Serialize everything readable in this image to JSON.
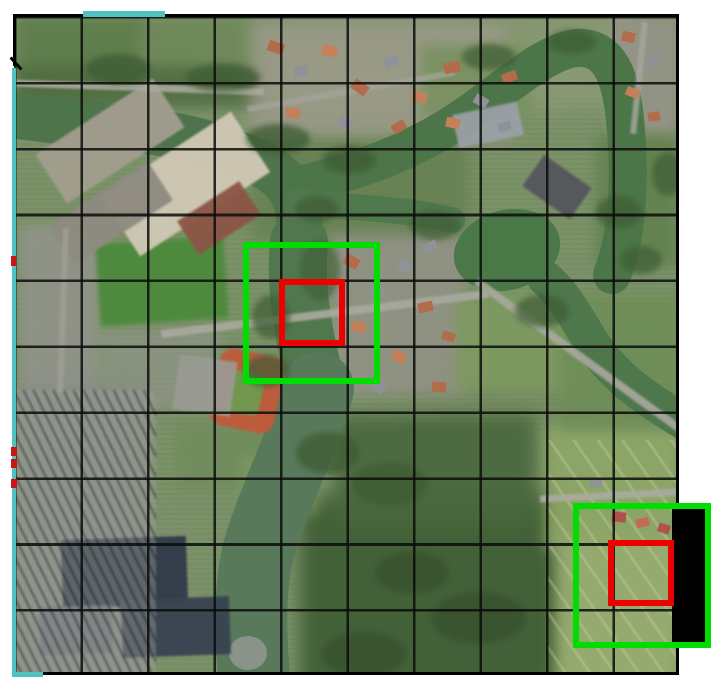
{
  "canvas": {
    "width": 716,
    "height": 687,
    "background": "#ffffff"
  },
  "aerial": {
    "left": 14,
    "top": 16,
    "width": 665,
    "height": 659
  },
  "grid": {
    "columns": 10,
    "rows": 10,
    "cell_width": 66.5,
    "cell_height": 65.9,
    "line_color": "rgba(10,12,10,0.85)",
    "line_width": 2.6
  },
  "annotations": {
    "context_box_color": "#00dd00",
    "target_box_color": "#ee0000",
    "box_border_width": 6,
    "context_boxes": [
      {
        "x": 243,
        "y": 242,
        "w": 137,
        "h": 142
      },
      {
        "x": 573,
        "y": 503,
        "w": 138,
        "h": 145
      }
    ],
    "target_boxes": [
      {
        "x": 279,
        "y": 279,
        "w": 66,
        "h": 67
      },
      {
        "x": 608,
        "y": 540,
        "w": 66,
        "h": 66
      }
    ],
    "out_of_bounds_mask": {
      "x": 672,
      "y": 507,
      "w": 37,
      "h": 135,
      "color": "#000000"
    },
    "boundary": {
      "color": "#000000",
      "segments": [
        {
          "x": 13,
          "y": 14,
          "w": 666,
          "h": 3
        },
        {
          "x": 676,
          "y": 14,
          "w": 3,
          "h": 661
        },
        {
          "x": 13,
          "y": 672,
          "w": 666,
          "h": 3
        },
        {
          "x": 13,
          "y": 14,
          "w": 3,
          "h": 52
        },
        {
          "x": 8,
          "y": 62,
          "w": 16,
          "h": 3,
          "rot": 48
        }
      ]
    },
    "footprint": {
      "color": "#4fc3c3",
      "segments": [
        {
          "x": 83,
          "y": 11,
          "w": 82,
          "h": 6
        },
        {
          "x": 12,
          "y": 68,
          "w": 4,
          "h": 609
        },
        {
          "x": 12,
          "y": 672,
          "w": 31,
          "h": 5
        }
      ]
    },
    "edge_ticks": {
      "color": "#cc1414",
      "segments": [
        {
          "x": 11,
          "y": 256,
          "w": 5,
          "h": 10
        },
        {
          "x": 11,
          "y": 447,
          "w": 6,
          "h": 9
        },
        {
          "x": 11,
          "y": 459,
          "w": 6,
          "h": 9
        },
        {
          "x": 11,
          "y": 479,
          "w": 6,
          "h": 9
        }
      ]
    }
  },
  "scene": {
    "water_color": "#4e744b",
    "rivers": [
      {
        "d": "M 5 114 C 90 128 190 124 268 168 C 298 186 302 214 299 246",
        "w": 46,
        "c": "#4e744b"
      },
      {
        "d": "M 299 242 C 294 292 305 342 318 392",
        "w": 58,
        "c": "#51774f"
      },
      {
        "d": "M 318 388 C 300 450 272 502 258 552 C 248 596 251 642 255 690",
        "w": 72,
        "c": "#587a5a"
      },
      {
        "d": "M 294 186 C 360 172 424 148 482 104 C 520 76 548 52 576 48 C 612 46 622 80 626 130 C 630 180 628 235 612 275",
        "w": 38,
        "c": "#4c7649"
      },
      {
        "d": "M 296 202 C 350 208 402 208 452 220",
        "w": 26,
        "c": "#50784d"
      },
      {
        "d": "M 545 278 C 572 302 582 332 602 357 C 626 386 652 402 684 422",
        "w": 36,
        "c": "#4e774c"
      }
    ],
    "ponds": [
      {
        "cx": 507,
        "cy": 250,
        "rx": 54,
        "ry": 40,
        "c": "#4a7847",
        "rot": -15
      },
      {
        "cx": 248,
        "cy": 653,
        "rx": 19,
        "ry": 17,
        "c": "#8a938a",
        "rot": 0
      }
    ],
    "features": [
      {
        "x": 16,
        "y": 16,
        "w": 130,
        "h": 80,
        "c": "#5d7c4b",
        "bl": 7,
        "o": 0.9,
        "layer": 0
      },
      {
        "x": 140,
        "y": 20,
        "w": 120,
        "h": 70,
        "c": "#6c8756",
        "bl": 7,
        "o": 0.8,
        "layer": 0
      },
      {
        "x": 16,
        "y": 66,
        "w": 250,
        "h": 42,
        "c": "#4f6c41",
        "bl": 6,
        "o": 0.85,
        "layer": 0
      },
      {
        "x": 250,
        "y": 20,
        "w": 260,
        "h": 120,
        "c": "#9b9a89",
        "bl": 8,
        "o": 0.85,
        "layer": 0
      },
      {
        "x": 508,
        "y": 16,
        "w": 120,
        "h": 90,
        "c": "#8a9a74",
        "bl": 8,
        "o": 0.8,
        "layer": 0
      },
      {
        "x": 610,
        "y": 16,
        "w": 68,
        "h": 120,
        "c": "#97948a",
        "bl": 6,
        "o": 0.85,
        "layer": 0
      },
      {
        "x": 250,
        "y": 140,
        "w": 220,
        "h": 100,
        "c": "#647f50",
        "bl": 8,
        "o": 0.8,
        "layer": 0
      },
      {
        "x": 330,
        "y": 235,
        "w": 135,
        "h": 160,
        "c": "#95928a",
        "bl": 7,
        "o": 0.8,
        "layer": 0
      },
      {
        "x": 20,
        "y": 225,
        "w": 80,
        "h": 170,
        "c": "#93948c",
        "bl": 6,
        "o": 0.85,
        "layer": 0
      },
      {
        "x": 100,
        "y": 330,
        "w": 120,
        "h": 80,
        "c": "#8f9488",
        "bl": 6,
        "o": 0.7,
        "layer": 0
      },
      {
        "x": 16,
        "y": 385,
        "w": 130,
        "h": 300,
        "c": "#878b86",
        "bl": 8,
        "o": 0.9,
        "layer": 0
      },
      {
        "x": 300,
        "y": 495,
        "w": 270,
        "h": 195,
        "c": "#415f36",
        "bl": 9,
        "o": 0.95,
        "layer": 0
      },
      {
        "x": 335,
        "y": 415,
        "w": 200,
        "h": 110,
        "c": "#4a683d",
        "bl": 8,
        "o": 0.9,
        "layer": 0
      },
      {
        "x": 545,
        "y": 425,
        "w": 135,
        "h": 125,
        "c": "#8ea868",
        "bl": 7,
        "o": 0.9,
        "layer": 0
      },
      {
        "x": 555,
        "y": 540,
        "w": 125,
        "h": 148,
        "c": "#97ac70",
        "bl": 7,
        "o": 0.95,
        "layer": 0
      },
      {
        "x": 455,
        "y": 295,
        "w": 130,
        "h": 95,
        "c": "#7e9b60",
        "bl": 7,
        "o": 0.85,
        "layer": 0
      },
      {
        "x": 560,
        "y": 295,
        "w": 120,
        "h": 135,
        "c": "#6e8d56",
        "bl": 7,
        "o": 0.85,
        "layer": 0
      },
      {
        "x": 596,
        "y": 135,
        "w": 84,
        "h": 130,
        "c": "#5f804c",
        "bl": 7,
        "o": 0.8,
        "layer": 0
      },
      {
        "x": 420,
        "y": 45,
        "w": 110,
        "h": 75,
        "c": "#74905a",
        "bl": 7,
        "o": 0.8,
        "layer": 0
      },
      {
        "x": 175,
        "y": 420,
        "w": 130,
        "h": 70,
        "c": "#6f8c59",
        "bl": 6,
        "o": 0.7,
        "layer": 0
      },
      {
        "x": 240,
        "y": 455,
        "w": 80,
        "h": 60,
        "c": "#7f9a64",
        "bl": 6,
        "o": 0.6,
        "layer": 0
      },
      {
        "x": 548,
        "y": 440,
        "w": 132,
        "h": 245,
        "g": "repeating-linear-gradient(55deg, rgba(205,210,160,0.4) 0 3px, rgba(0,0,0,0) 3px 20px)",
        "bl": 0,
        "o": 0.8,
        "layer": 1
      },
      {
        "x": 98,
        "y": 240,
        "w": 128,
        "h": 82,
        "c": "#4c8a3c",
        "r": -4,
        "bl": 2,
        "o": 0.95,
        "layer": 1
      },
      {
        "x": 214,
        "y": 352,
        "w": 66,
        "h": 78,
        "c": "#c05a3a",
        "r": 12,
        "br": 14,
        "bl": 1,
        "o": 0.95,
        "layer": 1
      },
      {
        "x": 228,
        "y": 372,
        "w": 34,
        "h": 42,
        "c": "#6e9a50",
        "r": 12,
        "br": 8,
        "bl": 1,
        "o": 0.95,
        "layer": 1
      },
      {
        "x": 176,
        "y": 358,
        "w": 58,
        "h": 55,
        "c": "#9a9c94",
        "r": 8,
        "bl": 1,
        "o": 0.9,
        "layer": 1
      },
      {
        "x": 40,
        "y": 112,
        "w": 140,
        "h": 58,
        "c": "#a49e90",
        "r": -33,
        "bl": 1,
        "o": 0.95,
        "layer": 1
      },
      {
        "x": 108,
        "y": 148,
        "w": 155,
        "h": 72,
        "c": "#cfc7b4",
        "r": -33,
        "bl": 1,
        "o": 0.97,
        "layer": 1
      },
      {
        "x": 52,
        "y": 190,
        "w": 118,
        "h": 46,
        "c": "#8e8b81",
        "r": -33,
        "bl": 1,
        "o": 0.95,
        "layer": 1
      },
      {
        "x": 182,
        "y": 198,
        "w": 74,
        "h": 40,
        "c": "#8c5546",
        "r": -33,
        "bl": 1,
        "o": 0.95,
        "layer": 1
      },
      {
        "x": 455,
        "y": 108,
        "w": 66,
        "h": 34,
        "c": "#9aa0a6",
        "r": -12,
        "bl": 1,
        "o": 0.95,
        "layer": 1
      },
      {
        "x": 528,
        "y": 168,
        "w": 58,
        "h": 38,
        "c": "#55565c",
        "r": 35,
        "bl": 1,
        "o": 0.95,
        "layer": 1
      },
      {
        "x": 62,
        "y": 538,
        "w": 125,
        "h": 68,
        "c": "#323c4a",
        "r": -2,
        "bl": 1,
        "o": 0.97,
        "layer": 1
      },
      {
        "x": 122,
        "y": 598,
        "w": 108,
        "h": 58,
        "c": "#3a4452",
        "r": -2,
        "bl": 1,
        "o": 0.97,
        "layer": 1
      },
      {
        "x": 40,
        "y": 606,
        "w": 72,
        "h": 48,
        "c": "#6e7278",
        "r": -2,
        "bl": 1,
        "o": 0.9,
        "layer": 1
      },
      {
        "x": 6,
        "y": 390,
        "w": 150,
        "h": 295,
        "g": "repeating-linear-gradient(64deg, rgba(55,60,58,0.75) 0 2px, rgba(160,162,158,0.45) 2px 9px)",
        "br": 10,
        "bl": 1,
        "o": 0.85,
        "layer": 1
      },
      {
        "x": 14,
        "y": 84,
        "w": 250,
        "h": 7,
        "c": "#a8a99e",
        "r": 2,
        "bl": 1,
        "o": 0.9,
        "layer": 1
      },
      {
        "x": 160,
        "y": 310,
        "w": 330,
        "h": 8,
        "c": "#a8a99e",
        "r": -7,
        "bl": 1,
        "o": 0.92,
        "layer": 1
      },
      {
        "x": 452,
        "y": 352,
        "w": 255,
        "h": 8,
        "c": "#a8a99e",
        "r": 36,
        "bl": 1,
        "o": 0.9,
        "layer": 1
      },
      {
        "x": 540,
        "y": 492,
        "w": 140,
        "h": 7,
        "c": "#abaca1",
        "r": -3,
        "bl": 1,
        "o": 0.9,
        "layer": 1
      },
      {
        "x": 636,
        "y": 22,
        "w": 6,
        "h": 112,
        "c": "#a5a69b",
        "r": 6,
        "bl": 1,
        "o": 0.85,
        "layer": 1
      },
      {
        "x": 60,
        "y": 228,
        "w": 6,
        "h": 165,
        "c": "#9fa096",
        "r": 2,
        "bl": 1,
        "o": 0.8,
        "layer": 1
      },
      {
        "x": 246,
        "y": 88,
        "w": 210,
        "h": 6,
        "c": "#a3a499",
        "r": -10,
        "bl": 1,
        "o": 0.8,
        "layer": 1
      },
      {
        "x": 86,
        "y": 54,
        "w": 64,
        "h": 30,
        "c": "#3e5c34",
        "br": "50%",
        "bl": 3,
        "o": 0.75,
        "layer": 1
      },
      {
        "x": 186,
        "y": 64,
        "w": 74,
        "h": 28,
        "c": "#3e5c34",
        "br": "50%",
        "bl": 3,
        "o": 0.75,
        "layer": 1
      },
      {
        "x": 246,
        "y": 124,
        "w": 64,
        "h": 30,
        "c": "#3e5c34",
        "br": "50%",
        "bl": 3,
        "o": 0.75,
        "layer": 1
      },
      {
        "x": 322,
        "y": 146,
        "w": 54,
        "h": 28,
        "c": "#3e5c34",
        "br": "50%",
        "bl": 3,
        "o": 0.75,
        "layer": 1
      },
      {
        "x": 295,
        "y": 196,
        "w": 44,
        "h": 26,
        "c": "#3e5c34",
        "br": "50%",
        "bl": 3,
        "o": 0.7,
        "layer": 1
      },
      {
        "x": 252,
        "y": 295,
        "w": 38,
        "h": 44,
        "c": "#3e5c34",
        "br": "50%",
        "bl": 3,
        "o": 0.7,
        "layer": 1
      },
      {
        "x": 245,
        "y": 355,
        "w": 44,
        "h": 32,
        "c": "#3e5c34",
        "br": "50%",
        "bl": 3,
        "o": 0.7,
        "layer": 1
      },
      {
        "x": 296,
        "y": 432,
        "w": 64,
        "h": 42,
        "c": "#3e5c34",
        "br": "50%",
        "bl": 3,
        "o": 0.75,
        "layer": 1
      },
      {
        "x": 352,
        "y": 462,
        "w": 76,
        "h": 44,
        "c": "#3e5c34",
        "br": "50%",
        "bl": 3,
        "o": 0.75,
        "layer": 1
      },
      {
        "x": 515,
        "y": 295,
        "w": 54,
        "h": 32,
        "c": "#3e5c34",
        "br": "50%",
        "bl": 3,
        "o": 0.7,
        "layer": 1
      },
      {
        "x": 596,
        "y": 196,
        "w": 46,
        "h": 32,
        "c": "#3e5c34",
        "br": "50%",
        "bl": 3,
        "o": 0.7,
        "layer": 1
      },
      {
        "x": 620,
        "y": 246,
        "w": 42,
        "h": 28,
        "c": "#3e5c34",
        "br": "50%",
        "bl": 3,
        "o": 0.7,
        "layer": 1
      },
      {
        "x": 462,
        "y": 44,
        "w": 54,
        "h": 26,
        "c": "#3e5c34",
        "br": "50%",
        "bl": 3,
        "o": 0.7,
        "layer": 1
      },
      {
        "x": 548,
        "y": 30,
        "w": 48,
        "h": 24,
        "c": "#3e5c34",
        "br": "50%",
        "bl": 3,
        "o": 0.7,
        "layer": 1
      },
      {
        "x": 652,
        "y": 152,
        "w": 32,
        "h": 44,
        "c": "#3e5c34",
        "br": "50%",
        "bl": 3,
        "o": 0.7,
        "layer": 1
      },
      {
        "x": 322,
        "y": 632,
        "w": 84,
        "h": 44,
        "c": "#37522e",
        "br": "50%",
        "bl": 3,
        "o": 0.8,
        "layer": 1
      },
      {
        "x": 432,
        "y": 592,
        "w": 94,
        "h": 52,
        "c": "#37522e",
        "br": "50%",
        "bl": 3,
        "o": 0.8,
        "layer": 1
      },
      {
        "x": 375,
        "y": 552,
        "w": 74,
        "h": 42,
        "c": "#37522e",
        "br": "50%",
        "bl": 3,
        "o": 0.8,
        "layer": 1
      },
      {
        "x": 300,
        "y": 240,
        "w": 40,
        "h": 60,
        "c": "#3e5c34",
        "br": "50%",
        "bl": 3,
        "o": 0.6,
        "layer": 1
      },
      {
        "x": 410,
        "y": 210,
        "w": 50,
        "h": 30,
        "c": "#3e5c34",
        "br": "50%",
        "bl": 3,
        "o": 0.65,
        "layer": 1
      },
      {
        "x": 268,
        "y": 42,
        "w": 16,
        "h": 11,
        "c": "#b26b4b",
        "r": 20,
        "layer": 1
      },
      {
        "x": 294,
        "y": 66,
        "w": 14,
        "h": 10,
        "c": "#90929a",
        "r": -15,
        "layer": 1
      },
      {
        "x": 322,
        "y": 46,
        "w": 15,
        "h": 10,
        "c": "#c68057",
        "r": 10,
        "layer": 1
      },
      {
        "x": 352,
        "y": 82,
        "w": 16,
        "h": 11,
        "c": "#b26b4b",
        "r": 35,
        "layer": 1
      },
      {
        "x": 384,
        "y": 56,
        "w": 14,
        "h": 10,
        "c": "#90929a",
        "r": -25,
        "layer": 1
      },
      {
        "x": 412,
        "y": 92,
        "w": 15,
        "h": 10,
        "c": "#c68057",
        "r": 15,
        "layer": 1
      },
      {
        "x": 444,
        "y": 62,
        "w": 16,
        "h": 11,
        "c": "#b26b4b",
        "r": -10,
        "layer": 1
      },
      {
        "x": 474,
        "y": 96,
        "w": 14,
        "h": 10,
        "c": "#90929a",
        "r": 30,
        "layer": 1
      },
      {
        "x": 502,
        "y": 72,
        "w": 15,
        "h": 10,
        "c": "#b26b4b",
        "r": -20,
        "layer": 1
      },
      {
        "x": 286,
        "y": 108,
        "w": 14,
        "h": 10,
        "c": "#c68057",
        "r": 5,
        "layer": 1
      },
      {
        "x": 338,
        "y": 118,
        "w": 15,
        "h": 10,
        "c": "#90929a",
        "r": 25,
        "layer": 1
      },
      {
        "x": 392,
        "y": 122,
        "w": 14,
        "h": 10,
        "c": "#b26b4b",
        "r": -30,
        "layer": 1
      },
      {
        "x": 446,
        "y": 118,
        "w": 14,
        "h": 10,
        "c": "#c68057",
        "r": 12,
        "layer": 1
      },
      {
        "x": 498,
        "y": 122,
        "w": 13,
        "h": 9,
        "c": "#90929a",
        "r": -18,
        "layer": 1
      },
      {
        "x": 344,
        "y": 256,
        "w": 15,
        "h": 11,
        "c": "#b26b4b",
        "r": 30,
        "layer": 1
      },
      {
        "x": 372,
        "y": 286,
        "w": 13,
        "h": 10,
        "c": "#90929a",
        "r": -20,
        "layer": 1
      },
      {
        "x": 352,
        "y": 322,
        "w": 14,
        "h": 10,
        "c": "#c68057",
        "r": 8,
        "layer": 1
      },
      {
        "x": 398,
        "y": 262,
        "w": 14,
        "h": 10,
        "c": "#90929a",
        "r": 22,
        "layer": 1
      },
      {
        "x": 418,
        "y": 302,
        "w": 15,
        "h": 10,
        "c": "#b26b4b",
        "r": -12,
        "layer": 1
      },
      {
        "x": 392,
        "y": 352,
        "w": 14,
        "h": 10,
        "c": "#c68057",
        "r": 28,
        "layer": 1
      },
      {
        "x": 432,
        "y": 382,
        "w": 14,
        "h": 10,
        "c": "#b26b4b",
        "r": 5,
        "layer": 1
      },
      {
        "x": 424,
        "y": 242,
        "w": 13,
        "h": 9,
        "c": "#90929a",
        "r": -25,
        "layer": 1
      },
      {
        "x": 442,
        "y": 332,
        "w": 13,
        "h": 9,
        "c": "#b26b4b",
        "r": 15,
        "layer": 1
      },
      {
        "x": 372,
        "y": 382,
        "w": 13,
        "h": 9,
        "c": "#90929a",
        "r": 40,
        "layer": 1
      },
      {
        "x": 622,
        "y": 32,
        "w": 13,
        "h": 10,
        "c": "#b26b4b",
        "r": 12,
        "layer": 1
      },
      {
        "x": 646,
        "y": 58,
        "w": 12,
        "h": 9,
        "c": "#90929a",
        "r": -14,
        "layer": 1
      },
      {
        "x": 626,
        "y": 88,
        "w": 13,
        "h": 9,
        "c": "#c68057",
        "r": 22,
        "layer": 1
      },
      {
        "x": 648,
        "y": 112,
        "w": 12,
        "h": 9,
        "c": "#b26b4b",
        "r": -8,
        "layer": 1
      },
      {
        "x": 612,
        "y": 512,
        "w": 14,
        "h": 10,
        "c": "#b2504b",
        "r": 6,
        "layer": 1
      },
      {
        "x": 636,
        "y": 518,
        "w": 13,
        "h": 9,
        "c": "#c66a57",
        "r": -12,
        "layer": 1
      },
      {
        "x": 658,
        "y": 524,
        "w": 12,
        "h": 9,
        "c": "#b2504b",
        "r": 18,
        "layer": 1
      },
      {
        "x": 590,
        "y": 478,
        "w": 12,
        "h": 9,
        "c": "#90929a",
        "r": 10,
        "layer": 1
      }
    ]
  }
}
